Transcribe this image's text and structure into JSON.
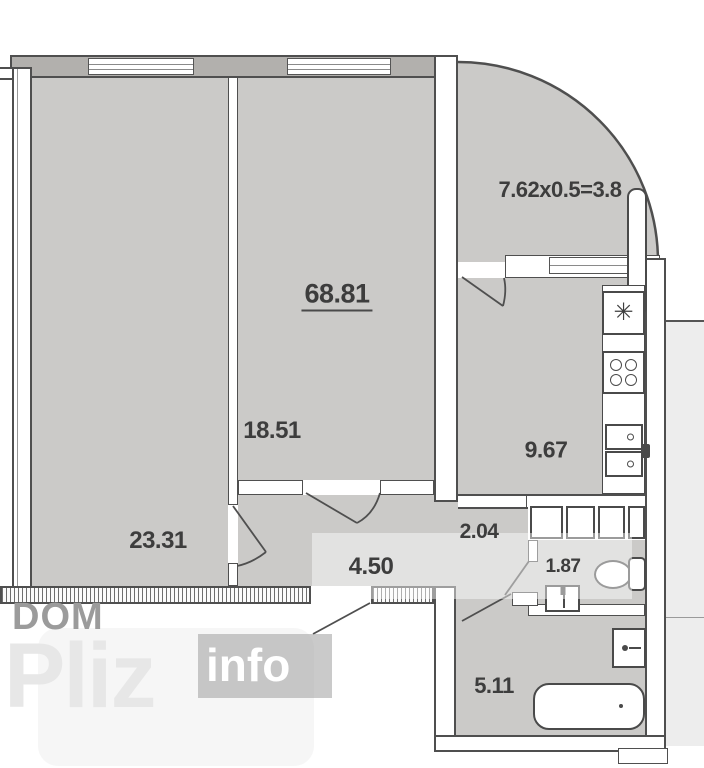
{
  "plan": {
    "total_area": "68.81",
    "balcony_formula": "7.62x0.5=3.8",
    "rooms": [
      {
        "id": "bedroom",
        "area": "23.31"
      },
      {
        "id": "living",
        "area": "18.51"
      },
      {
        "id": "kitchen",
        "area": "9.67"
      },
      {
        "id": "hallway",
        "area": "4.50"
      },
      {
        "id": "corridor",
        "area": "2.04"
      },
      {
        "id": "wc",
        "area": "1.87"
      },
      {
        "id": "bathroom",
        "area": "5.11"
      }
    ],
    "icons": {
      "fridge": "✳"
    },
    "colors": {
      "room_fill": "#cbcac8",
      "wall_line": "#4f4f4f",
      "wall_fill": "#ffffff",
      "exterior_wall_fill": "#b2b0ad"
    }
  },
  "watermark": {
    "dom": "DOM",
    "pliz": "Pliz",
    "info": "info"
  }
}
